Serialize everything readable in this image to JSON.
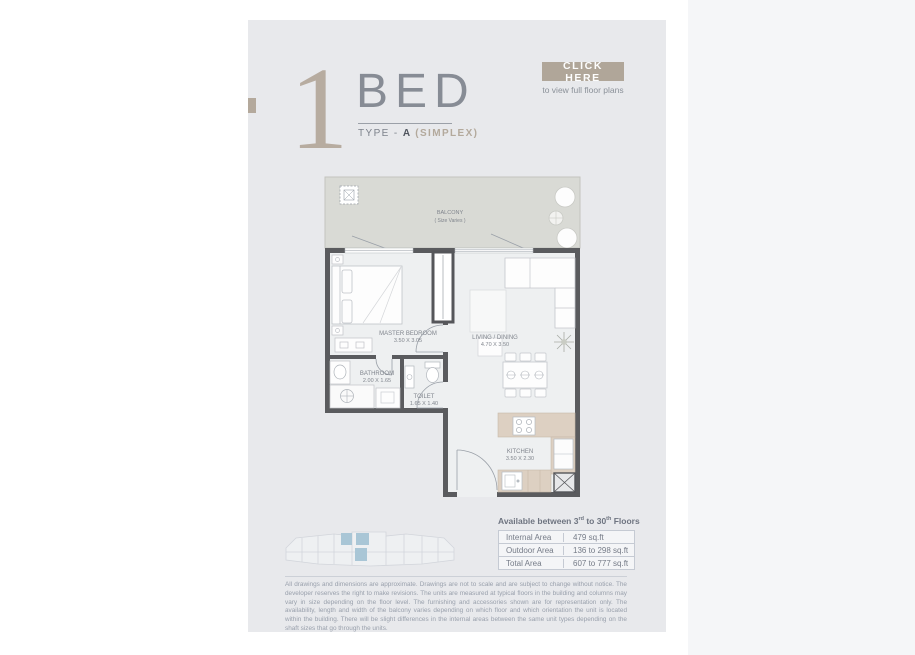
{
  "header": {
    "number": "1",
    "title": "BED",
    "type_prefix": "TYPE - ",
    "type_letter": "A",
    "type_suffix": " (SIMPLEX)",
    "cta_label": "CLICK HERE",
    "cta_sub": "to view full floor plans"
  },
  "plan": {
    "balcony_label": "BALCONY",
    "balcony_note": "( Size Varies )",
    "rooms": {
      "bedroom": {
        "name": "MASTER BEDROOM",
        "dims": "3.50 X 3.05"
      },
      "living": {
        "name": "LIVING / DINING",
        "dims": "4.70 X 3.50"
      },
      "bathroom": {
        "name": "BATHROOM",
        "dims": "2.00 X 1.65"
      },
      "toilet": {
        "name": "TOILET",
        "dims": "1.65 X 1.40"
      },
      "kitchen": {
        "name": "KITCHEN",
        "dims": "3.50 X 2.30"
      }
    }
  },
  "availability": {
    "pre": "Available between 3",
    "sup1": "rd",
    "mid": " to 30",
    "sup2": "th",
    "post": " Floors"
  },
  "area_table": {
    "rows": [
      {
        "label": "Internal Area",
        "value": "479 sq.ft"
      },
      {
        "label": "Outdoor Area",
        "value": "136 to 298 sq.ft"
      },
      {
        "label": "Total Area",
        "value": "607 to 777 sq.ft"
      }
    ]
  },
  "disclaimer": "All drawings and dimensions are approximate. Drawings are not to scale and are subject to change without notice. The developer reserves the right to make revisions. The units are measured at typical floors in the building and columns may vary in size depending on the floor level. The furnishing and accessories shown are for representation only. The availability, length and width of the balcony varies depending on which floor and which orientation the unit is located within the building. There will be slight differences in the internal areas between the same unit types depending on the shaft sizes that go through the units.",
  "colors": {
    "accent_tan": "#b0a699",
    "panel_bg": "#e8e9ec",
    "wall": "#5a5b5e",
    "balcony_fill": "#d9dad5",
    "counter_tan": "#ddd0c2",
    "keyplan_highlight": "#a9c6d6"
  }
}
